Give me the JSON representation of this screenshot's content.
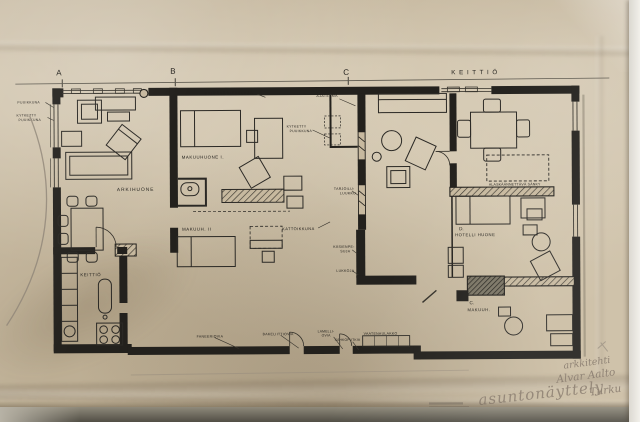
{
  "drawing": {
    "section_marks": {
      "a": "A",
      "b": "B",
      "c": "C"
    },
    "kitchen_header": "K E I T T I Ö",
    "rooms": {
      "living": "ARKIHUONE",
      "bedroom1": "MAKUUHUONE I.",
      "bedroom2": "MAKUUH. II",
      "kitchen": "KEITTIÖ",
      "skylight": "KATTOIKKUNA",
      "hotel_mark": "D.",
      "hotel": "HOTELLI HUONE",
      "bedroom_c_mark": "C.",
      "bedroom_c": "MAKUUH."
    },
    "annotations": {
      "left_window_1": "PUUIKKUNA",
      "left_window_2a": "KYTKETTY",
      "left_window_2b": "PUUIKKUNA",
      "wall_note": "SEINÄKÄSITTELYJÄ",
      "photo_note_a": "VALOKUVA-",
      "photo_note_b": "AJATELMA",
      "coupled_window_a": "KYTKETTY",
      "coupled_window_b": "PUUIKKUNA",
      "serving_a": "TARJOILU-",
      "serving_b": "LUUKKU",
      "handwash_a": "KÄSIENPE-",
      "handwash_b": "SUJA",
      "locks": "LUKKOJA",
      "fold_bed": "ALASKÄÄNNETTÄVÄ SÄNKY",
      "bottom": {
        "l1": "FANEERIOVIA",
        "l2": "BAKELIITTIOVIA",
        "l3a": "LAMELLI-",
        "l3b": "OVIA",
        "l4": "SÄHKÖPUTKIA",
        "l5": "VAATENAULAKKO"
      }
    },
    "handwriting": {
      "architect": "arkkitehti",
      "name": "Alvar Aalto",
      "city": "Turku",
      "exhibition": "asuntonäyttely"
    },
    "colors": {
      "paper": "#cbbda3",
      "ink": "#23211d",
      "pencil": "#8b7f6f",
      "desk": "#514e45"
    }
  }
}
